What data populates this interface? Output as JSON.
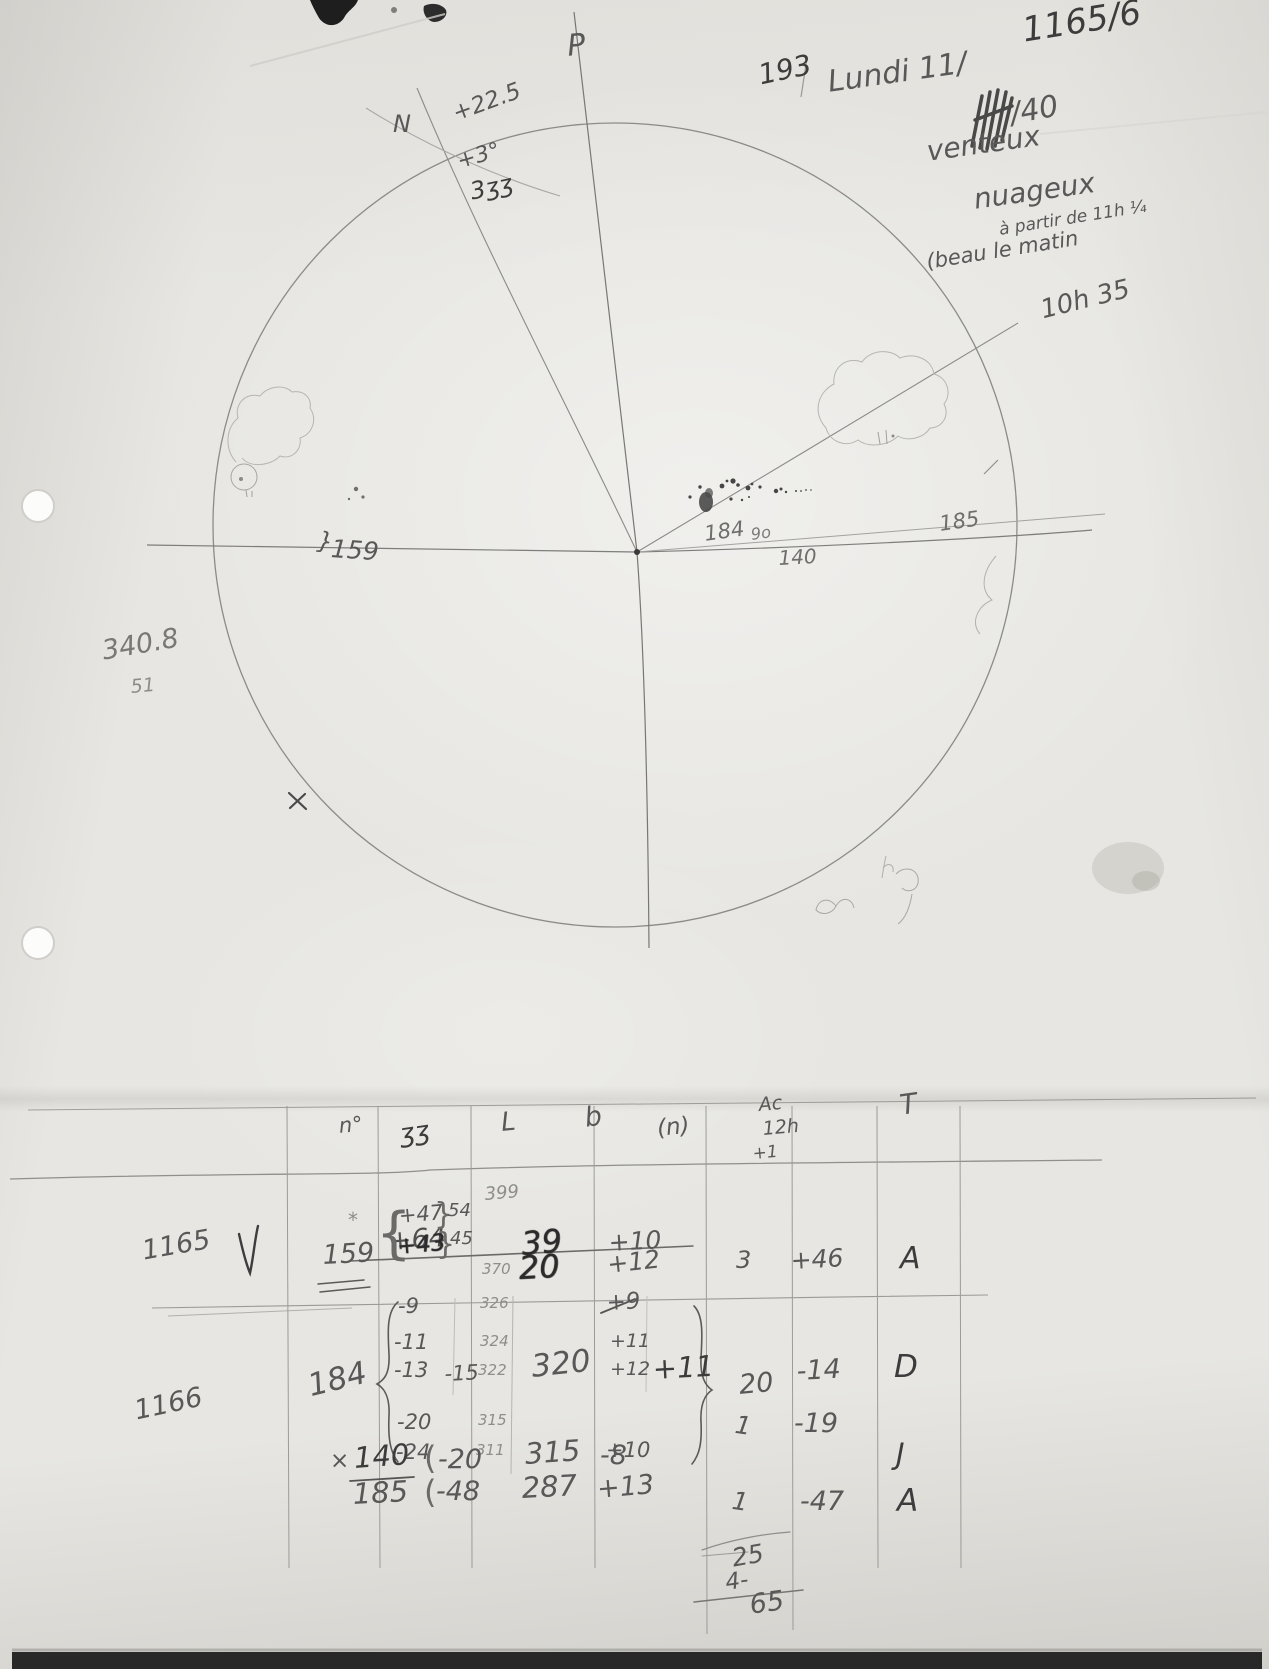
{
  "document": {
    "sheet_number": "1165/6",
    "observation_number": "193",
    "date_prefix": "Lundi 11/",
    "date_year": "/40",
    "weather": {
      "line1": "venteux",
      "line2": "nuageux",
      "line3": "à partir de 11h ¼",
      "line4": "(beau le matin",
      "time": "10h 35"
    }
  },
  "disk": {
    "pole": "P",
    "north": "N",
    "tilt": "+22.5",
    "angle": "+3°",
    "note": "3ʒʒ",
    "left_group_brace": "}",
    "left_group": "159",
    "center_group": "184",
    "center_group_note": "9o",
    "lower_group": "140",
    "right_group": "185",
    "margin_top": "340.8",
    "margin_bottom": "51",
    "cross_mark": "×"
  },
  "table": {
    "headers": {
      "c1": "n°",
      "c2": "ʒʒ",
      "c3": "L",
      "c4": "b",
      "c5": "(n)",
      "c6_line1": "Ac",
      "c6_line2": "12h",
      "c6_line3": "+1",
      "c7": "T"
    },
    "row_1165": {
      "id": "1165",
      "mark": "*",
      "group": "159",
      "struck_c2": "+64",
      "struck_l": "399",
      "struck_l2": "39",
      "struck_b": "+10",
      "c2_open_brace": "{",
      "c2_line1": "+47",
      "c2_line1_close": "}",
      "c2_line1_sub": "54",
      "c2_line2": "+43",
      "c2_line2_close": "}",
      "c2_line2_sub": "45",
      "l_small": "370",
      "l": "20",
      "b": "+12",
      "n": "3",
      "ac": "+46",
      "type": "A"
    },
    "row_1166": {
      "id": "1166",
      "group": "184",
      "c2_values": [
        "-9",
        "-11",
        "-13",
        "-20",
        "-24"
      ],
      "c2_mean": "-15",
      "l_values": [
        "326",
        "324",
        "322",
        "315",
        "311"
      ],
      "l": "320",
      "b_struck": "+9",
      "b_values": [
        "+11",
        "+12",
        "+10"
      ],
      "b_mean": "+11",
      "n": "20",
      "ac": "-14",
      "type": "D"
    },
    "row_140": {
      "prefix": "×",
      "group": "140",
      "c2_paren": "(",
      "c2": "-20",
      "l": "315",
      "b": "-8",
      "n": "1",
      "ac": "-19",
      "type": "J"
    },
    "row_185": {
      "group": "185",
      "c2_paren": "(",
      "c2": "-48",
      "l": "287",
      "b": "+13",
      "n": "1",
      "ac": "-47",
      "type": "A"
    },
    "totals": {
      "spot_count": "25",
      "group_count": "4-",
      "total": "65"
    }
  }
}
